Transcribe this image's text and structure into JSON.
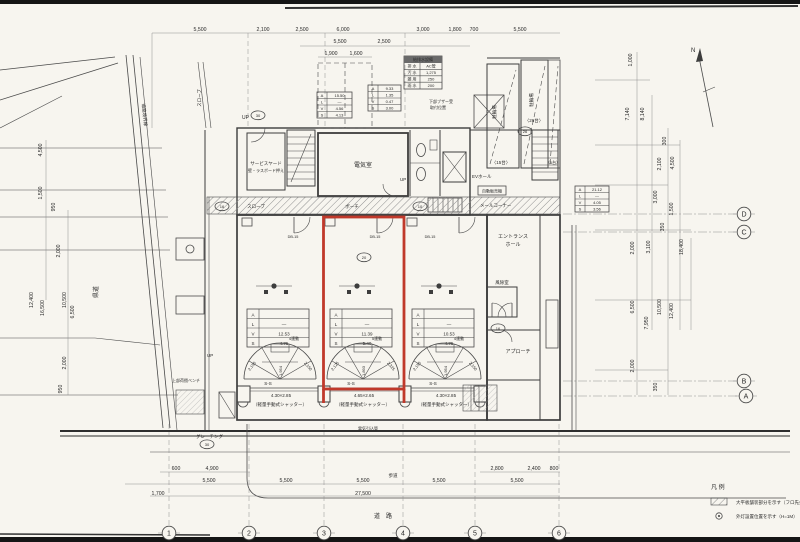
{
  "palette": {
    "paper": "#f7f5ef",
    "ink": "#3d3d3d",
    "dim_line": "#8f8f8f",
    "text": "#2a2a2a",
    "highlight": "#c0392b"
  },
  "north": {
    "label": "N"
  },
  "legend": {
    "title": "凡 例",
    "items": [
      {
        "symbol": "hatch-swatch",
        "label": "大平板舗装部分を示す（フロ先共）"
      },
      {
        "symbol": "circle-dot",
        "label": "外灯設置位置を示す（H=1M）"
      }
    ]
  },
  "road": {
    "prefectural": "県道",
    "boundary": "道路境界線",
    "bottom": "道　路",
    "grating": "グレーチング"
  },
  "rooms": {
    "electrical": "電気室",
    "service_yard": "サービスヤード",
    "service_yard_note": "壁・ラスボード押え",
    "ev_hall": "EVホール",
    "vending": "自動販売機",
    "mail_corner": "メールコーナー",
    "entrance_l1": "エントランス",
    "entrance_l2": "ホール",
    "windbreak": "風除室",
    "approach": "アプローチ",
    "bike_a": "駐輪場",
    "bike_a_count": "〈15台〉",
    "bike_b": "駐輪場",
    "bike_b_count": "〈26台〉",
    "bike_c_count": "〈6台〉",
    "slope_upper": "スロープ",
    "slope_porch": "スロープ",
    "porch": "ポーチ",
    "bench": "上部荷捌ベンチ",
    "up1": "UP",
    "up2": "UP",
    "up3": "UP"
  },
  "units": [
    {
      "name": "store-left",
      "ss": "S-S",
      "size": "4.30×2.85",
      "shutter": "（軽量手動式シャッター）",
      "fan": {
        "left": "2,150",
        "right": "2,150",
        "height": "1,954",
        "note": "4連動"
      },
      "table": {
        "rows": [
          [
            "A",
            ""
          ],
          [
            "L",
            "—"
          ],
          [
            "V",
            "12.53"
          ],
          [
            "S",
            "4.75"
          ]
        ]
      }
    },
    {
      "name": "store-middle-highlighted",
      "ss": "S-S",
      "size": "4.65×2.65",
      "shutter": "（軽量手動式シャッター）",
      "fan": {
        "left": "2,125",
        "right": "2,325",
        "height": "1,893",
        "note": "5連動"
      },
      "table": {
        "rows": [
          [
            "A",
            ""
          ],
          [
            "L",
            "—"
          ],
          [
            "V",
            "11.39"
          ],
          [
            "S",
            "5.40"
          ]
        ]
      }
    },
    {
      "name": "store-right",
      "ss": "S-S",
      "size": "4.30×2.85",
      "shutter": "（軽量手動式シャッター）",
      "fan": {
        "left": "2,150",
        "right": "2,150",
        "height": "1,954",
        "note": "4連動"
      },
      "table": {
        "rows": [
          [
            "A",
            ""
          ],
          [
            "L",
            "—"
          ],
          [
            "V",
            "10.53"
          ],
          [
            "S",
            "4.75"
          ]
        ]
      }
    }
  ],
  "grid": {
    "bottom": [
      {
        "label": "1",
        "x": 169,
        "y": 533
      },
      {
        "label": "2",
        "x": 249,
        "y": 533
      },
      {
        "label": "3",
        "x": 324,
        "y": 533
      },
      {
        "label": "4",
        "x": 403,
        "y": 533
      },
      {
        "label": "5",
        "x": 475,
        "y": 533
      },
      {
        "label": "6",
        "x": 559,
        "y": 533
      }
    ],
    "right": [
      {
        "label": "D",
        "x": 744,
        "y": 214
      },
      {
        "label": "C",
        "x": 744,
        "y": 232
      },
      {
        "label": "B",
        "x": 744,
        "y": 381
      },
      {
        "label": "A",
        "x": 746,
        "y": 396
      }
    ]
  },
  "aux_tables": {
    "drain": {
      "title": "給排水設備",
      "x": 404,
      "y": 56,
      "w": 38,
      "h": 33,
      "rh": 6.4,
      "title_h": 7,
      "split": 16,
      "rows": [
        [
          "排 水",
          "AC管"
        ],
        [
          "汚 水",
          "1,275"
        ],
        [
          "雑 用",
          "250"
        ],
        [
          "雨 水",
          "200"
        ]
      ]
    },
    "area1": {
      "x": 317,
      "y": 92,
      "w": 35,
      "h": 26,
      "rh": 6.5,
      "split": 10,
      "rows": [
        [
          "A",
          "15.50"
        ],
        [
          "L",
          "—"
        ],
        [
          "V",
          "4.56"
        ],
        [
          "S",
          "4.13"
        ]
      ]
    },
    "area2": {
      "x": 368,
      "y": 85,
      "w": 33,
      "h": 26,
      "rh": 6.5,
      "split": 10,
      "rows": [
        [
          "A",
          "9.33"
        ],
        [
          "L",
          "1.35"
        ],
        [
          "V",
          "0.47"
        ],
        [
          "S",
          "3.00"
        ]
      ]
    },
    "approach": {
      "x": 575,
      "y": 186,
      "w": 34,
      "h": 26,
      "rh": 6.5,
      "split": 10,
      "rows": [
        [
          "A",
          "21.12"
        ],
        [
          "L",
          "—"
        ],
        [
          "V",
          "4.05"
        ],
        [
          "S",
          "3.56"
        ]
      ]
    }
  },
  "annotations": {
    "dims_top": [
      {
        "t": "5,500",
        "x": 200,
        "y": 31
      },
      {
        "t": "2,100",
        "x": 263,
        "y": 31
      },
      {
        "t": "2,500",
        "x": 302,
        "y": 31
      },
      {
        "t": "6,000",
        "x": 343,
        "y": 31
      },
      {
        "t": "3,000",
        "x": 423,
        "y": 31
      },
      {
        "t": "1,800",
        "x": 455,
        "y": 31
      },
      {
        "t": "700",
        "x": 474,
        "y": 31
      },
      {
        "t": "5,500",
        "x": 520,
        "y": 31
      },
      {
        "t": "5,500",
        "x": 340,
        "y": 43
      },
      {
        "t": "2,500",
        "x": 384,
        "y": 43
      },
      {
        "t": "1,900",
        "x": 331,
        "y": 55
      },
      {
        "t": "1,600",
        "x": 356,
        "y": 55
      }
    ],
    "dims_left": [
      {
        "t": "4,500",
        "x": 42,
        "y": 150,
        "r": -90
      },
      {
        "t": "1,500",
        "x": 42,
        "y": 193,
        "r": -90
      },
      {
        "t": "950",
        "x": 55,
        "y": 207,
        "r": -90
      },
      {
        "t": "2,000",
        "x": 60,
        "y": 251,
        "r": -90
      },
      {
        "t": "12,400",
        "x": 33,
        "y": 300,
        "r": -90
      },
      {
        "t": "16,500",
        "x": 44,
        "y": 308,
        "r": -90
      },
      {
        "t": "10,500",
        "x": 66,
        "y": 300,
        "r": -90
      },
      {
        "t": "6,500",
        "x": 74,
        "y": 312,
        "r": -90
      },
      {
        "t": "2,000",
        "x": 66,
        "y": 363,
        "r": -90
      },
      {
        "t": "950",
        "x": 62,
        "y": 389,
        "r": -90
      }
    ],
    "dims_right": [
      {
        "t": "1,000",
        "x": 632,
        "y": 60,
        "r": -90
      },
      {
        "t": "7,140",
        "x": 629,
        "y": 114,
        "r": -90
      },
      {
        "t": "8,140",
        "x": 644,
        "y": 114,
        "r": -90
      },
      {
        "t": "300",
        "x": 666,
        "y": 141,
        "r": -90
      },
      {
        "t": "2,100",
        "x": 661,
        "y": 164,
        "r": -90
      },
      {
        "t": "4,500",
        "x": 674,
        "y": 163,
        "r": -90
      },
      {
        "t": "3,000",
        "x": 657,
        "y": 197,
        "r": -90
      },
      {
        "t": "1,500",
        "x": 673,
        "y": 209,
        "r": -90
      },
      {
        "t": "350",
        "x": 664,
        "y": 227,
        "r": -90
      },
      {
        "t": "2,000",
        "x": 634,
        "y": 248,
        "r": -90
      },
      {
        "t": "3,100",
        "x": 650,
        "y": 247,
        "r": -90
      },
      {
        "t": "18,400",
        "x": 683,
        "y": 247,
        "r": -90
      },
      {
        "t": "6,500",
        "x": 634,
        "y": 307,
        "r": -90
      },
      {
        "t": "7,950",
        "x": 648,
        "y": 323,
        "r": -90
      },
      {
        "t": "10,500",
        "x": 661,
        "y": 307,
        "r": -90
      },
      {
        "t": "12,400",
        "x": 673,
        "y": 311,
        "r": -90
      },
      {
        "t": "2,000",
        "x": 634,
        "y": 366,
        "r": -90
      },
      {
        "t": "350",
        "x": 657,
        "y": 387,
        "r": -90
      }
    ],
    "dims_bottom": [
      {
        "t": "600",
        "x": 176,
        "y": 470
      },
      {
        "t": "4,900",
        "x": 212,
        "y": 470
      },
      {
        "t": "2,800",
        "x": 497,
        "y": 470
      },
      {
        "t": "2,400",
        "x": 534,
        "y": 470
      },
      {
        "t": "800",
        "x": 554,
        "y": 470
      },
      {
        "t": "5,500",
        "x": 209,
        "y": 482
      },
      {
        "t": "5,500",
        "x": 286,
        "y": 482
      },
      {
        "t": "5,500",
        "x": 363,
        "y": 482
      },
      {
        "t": "5,500",
        "x": 439,
        "y": 482
      },
      {
        "t": "5,500",
        "x": 517,
        "y": 482
      },
      {
        "t": "27,500",
        "x": 363,
        "y": 495
      },
      {
        "t": "1,700",
        "x": 158,
        "y": 495
      }
    ],
    "door_codes": [
      {
        "t": "DB-15",
        "x": 293,
        "y": 238,
        "s": 3.8
      },
      {
        "t": "DB-15",
        "x": 375,
        "y": 238,
        "s": 3.8
      },
      {
        "t": "DB-15",
        "x": 430,
        "y": 238,
        "s": 3.8
      }
    ],
    "circle_numbers": [
      {
        "t": "30",
        "x": 258,
        "y": 117,
        "s": 4
      },
      {
        "t": "16",
        "x": 222,
        "y": 208,
        "s": 4
      },
      {
        "t": "10",
        "x": 420,
        "y": 208,
        "s": 4
      },
      {
        "t": "20",
        "x": 364,
        "y": 259,
        "s": 4
      },
      {
        "t": "16",
        "x": 498,
        "y": 330,
        "s": 4
      },
      {
        "t": "30",
        "x": 207,
        "y": 446,
        "s": 4
      },
      {
        "t": "26",
        "x": 525,
        "y": 133,
        "s": 4
      }
    ],
    "notes": [
      {
        "t": "下部ブザー受",
        "x": 441,
        "y": 103,
        "s": 4
      },
      {
        "t": "取付位置",
        "x": 438,
        "y": 109,
        "s": 4
      },
      {
        "t": "電気引込管",
        "x": 368,
        "y": 430,
        "s": 4
      },
      {
        "t": "歩道",
        "x": 393,
        "y": 477,
        "s": 4.5
      }
    ]
  }
}
